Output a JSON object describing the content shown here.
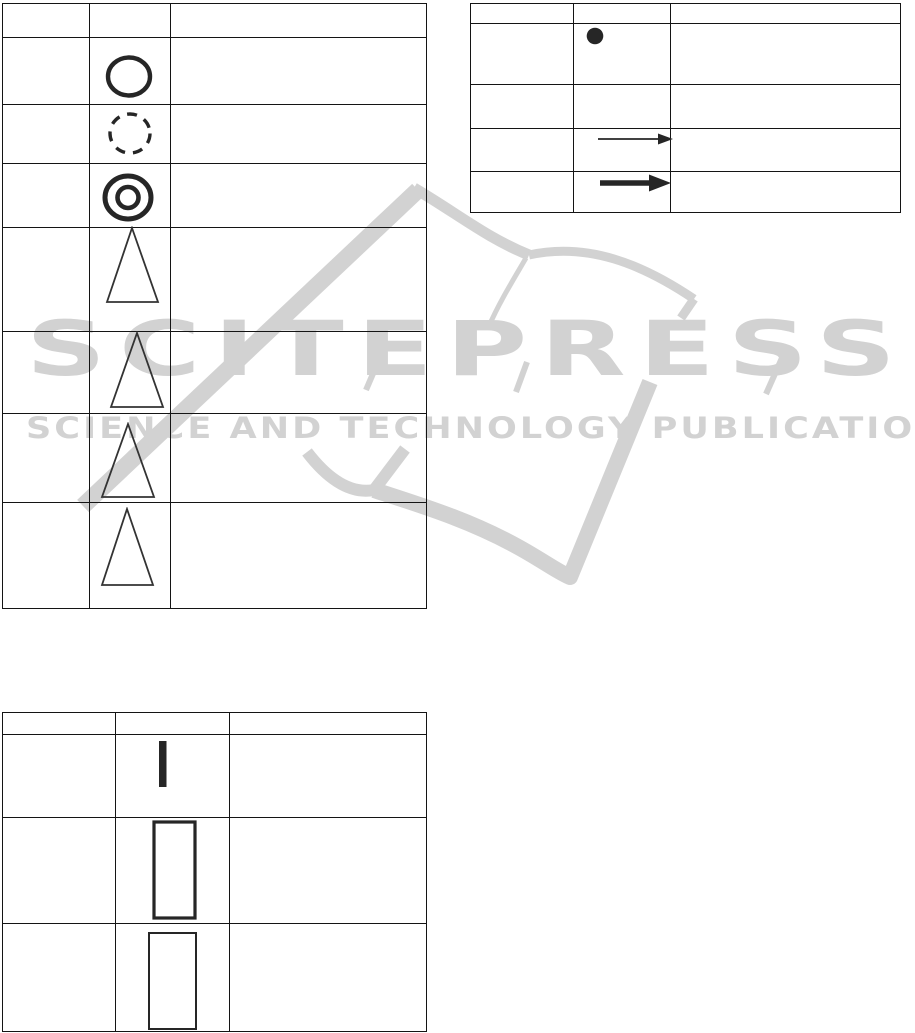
{
  "watermark": {
    "brand": "SCITEPRESS",
    "tagline": "SCIENCE AND TECHNOLOGY PUBLICATIONS",
    "color": "#d2d2d2"
  },
  "ink_color": "#262626",
  "table_border_color": "#141414",
  "tables": {
    "top_left": {
      "rows": 8,
      "cols": 3,
      "header_row_empty": true,
      "symbol_column_index": 1,
      "row_symbols": [
        "",
        "circle-bold-outline",
        "circle-dashed-outline",
        "circle-double-outline",
        "triangle-outline",
        "triangle-outline",
        "triangle-outline",
        "triangle-outline"
      ]
    },
    "top_right": {
      "rows": 5,
      "cols": 3,
      "header_row_empty": true,
      "symbol_column_index": 1,
      "row_symbols": [
        "",
        "dot-filled",
        "",
        "arrow-thin-right",
        "arrow-thick-right"
      ]
    },
    "bottom_left": {
      "rows": 4,
      "cols": 3,
      "header_row_empty": true,
      "symbol_column_index": 1,
      "row_symbols": [
        "",
        "vertical-bar-filled",
        "rectangle-tall-thick-outline",
        "rectangle-tall-thin-outline"
      ]
    }
  }
}
